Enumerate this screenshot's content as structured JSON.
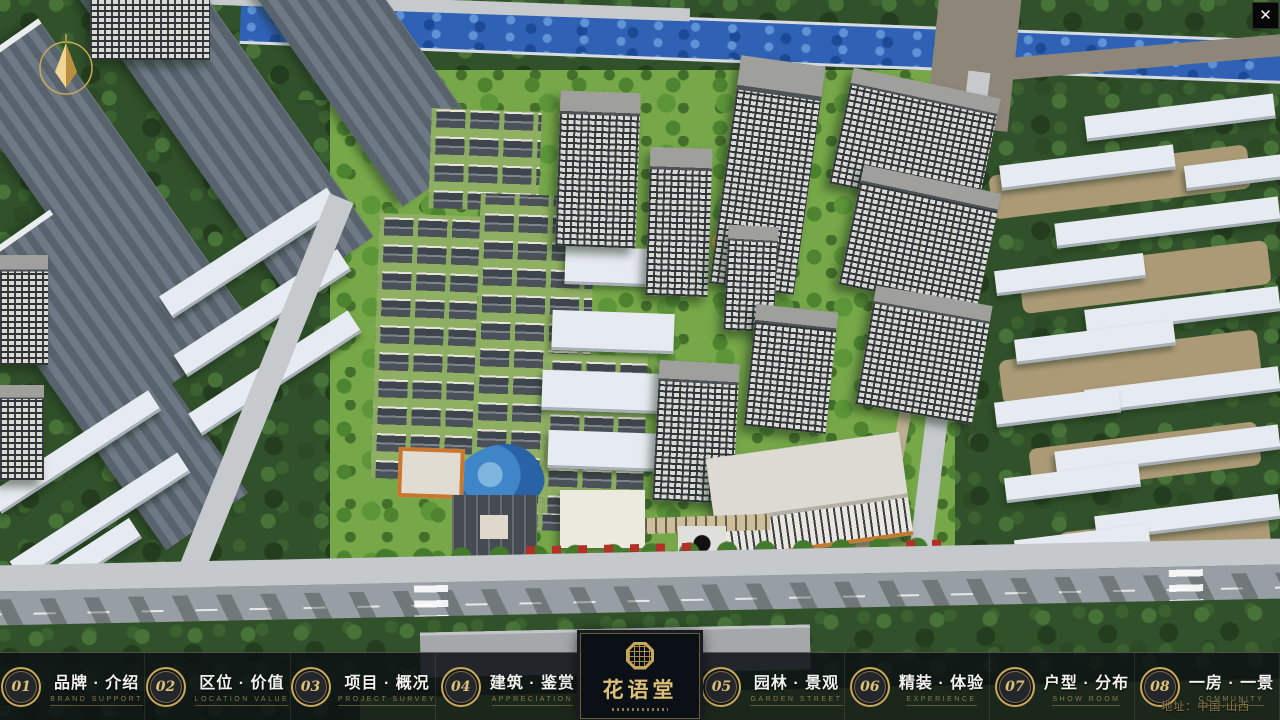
{
  "window": {
    "close_glyph": "✕"
  },
  "scene": {
    "kind": "aerial-3d-masterplan-rendering",
    "address_label": "地址：中国·山西"
  },
  "logo": {
    "title": "花语堂"
  },
  "nav": {
    "items": [
      {
        "num": "01",
        "title": "品牌 · 介绍",
        "subtitle": "BRAND SUPPORT"
      },
      {
        "num": "02",
        "title": "区位 · 价值",
        "subtitle": "LOCATION VALUE"
      },
      {
        "num": "03",
        "title": "项目 · 概况",
        "subtitle": "PROJECT SURVEY"
      },
      {
        "num": "04",
        "title": "建筑 · 鉴赏",
        "subtitle": "APPRECIATION"
      },
      {
        "num": "05",
        "title": "园林 · 景观",
        "subtitle": "GARDEN STREET"
      },
      {
        "num": "06",
        "title": "精装 · 体验",
        "subtitle": "EXPERIENCE"
      },
      {
        "num": "07",
        "title": "户型 · 分布",
        "subtitle": "SHOW ROOM"
      },
      {
        "num": "08",
        "title": "一房 · 一景",
        "subtitle": "COMMUNITY"
      }
    ]
  },
  "colors": {
    "gold": "#c9a959",
    "bar_bg": "rgba(12,15,19,0.85)",
    "lawn_green": "#7cab4c",
    "river_blue": "#2f62b5"
  }
}
